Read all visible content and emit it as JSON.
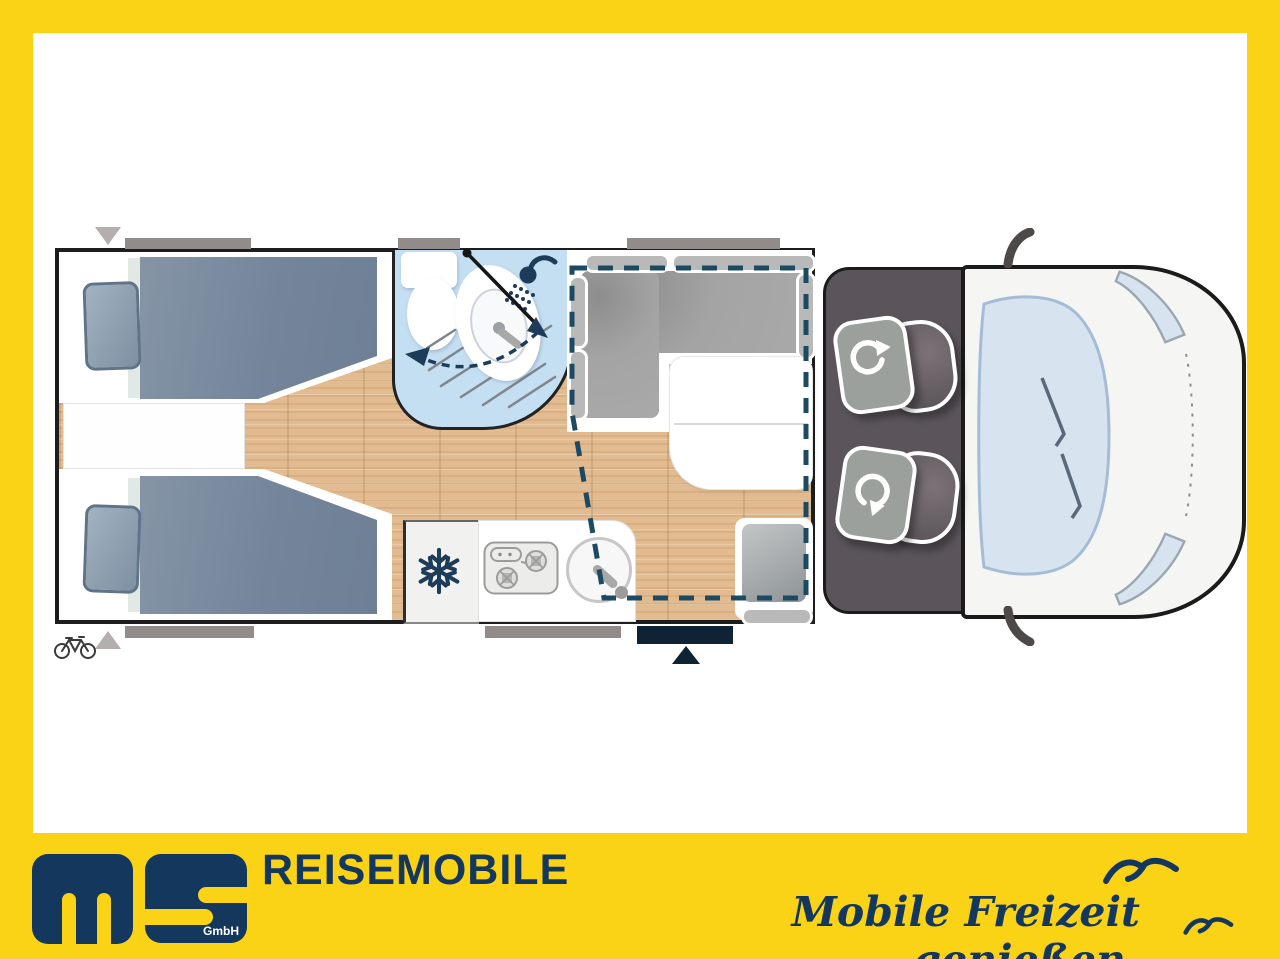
{
  "brand": {
    "logo_letters": "ms",
    "logo_suffix": "GmbH",
    "wordmark": "REISEMOBILE",
    "slogan": "Mobile Freizeit genießen."
  },
  "colors": {
    "frame_yellow": "#FBD316",
    "brand_navy": "#14375E",
    "bathroom_blue": "#C4DEF2",
    "wood_floor": "#E2BC90",
    "cab_gray": "#5B555B",
    "mattress_gray_blue": "#7A8B9E",
    "dashed_bed_outline": "#1D4A63",
    "entry_door_navy": "#0E2334"
  },
  "floorplan_icons": [
    {
      "name": "snowflake-icon",
      "meaning": "refrigerator"
    },
    {
      "name": "shower-head-icon",
      "meaning": "shower"
    },
    {
      "name": "rotation-arrow-icon",
      "meaning": "swivel cab seat"
    },
    {
      "name": "bicycle-icon",
      "meaning": "bike storage at rear"
    },
    {
      "name": "entry-arrow-icon",
      "meaning": "entrance door"
    },
    {
      "name": "seagull-icon",
      "meaning": "brand decoration"
    }
  ]
}
